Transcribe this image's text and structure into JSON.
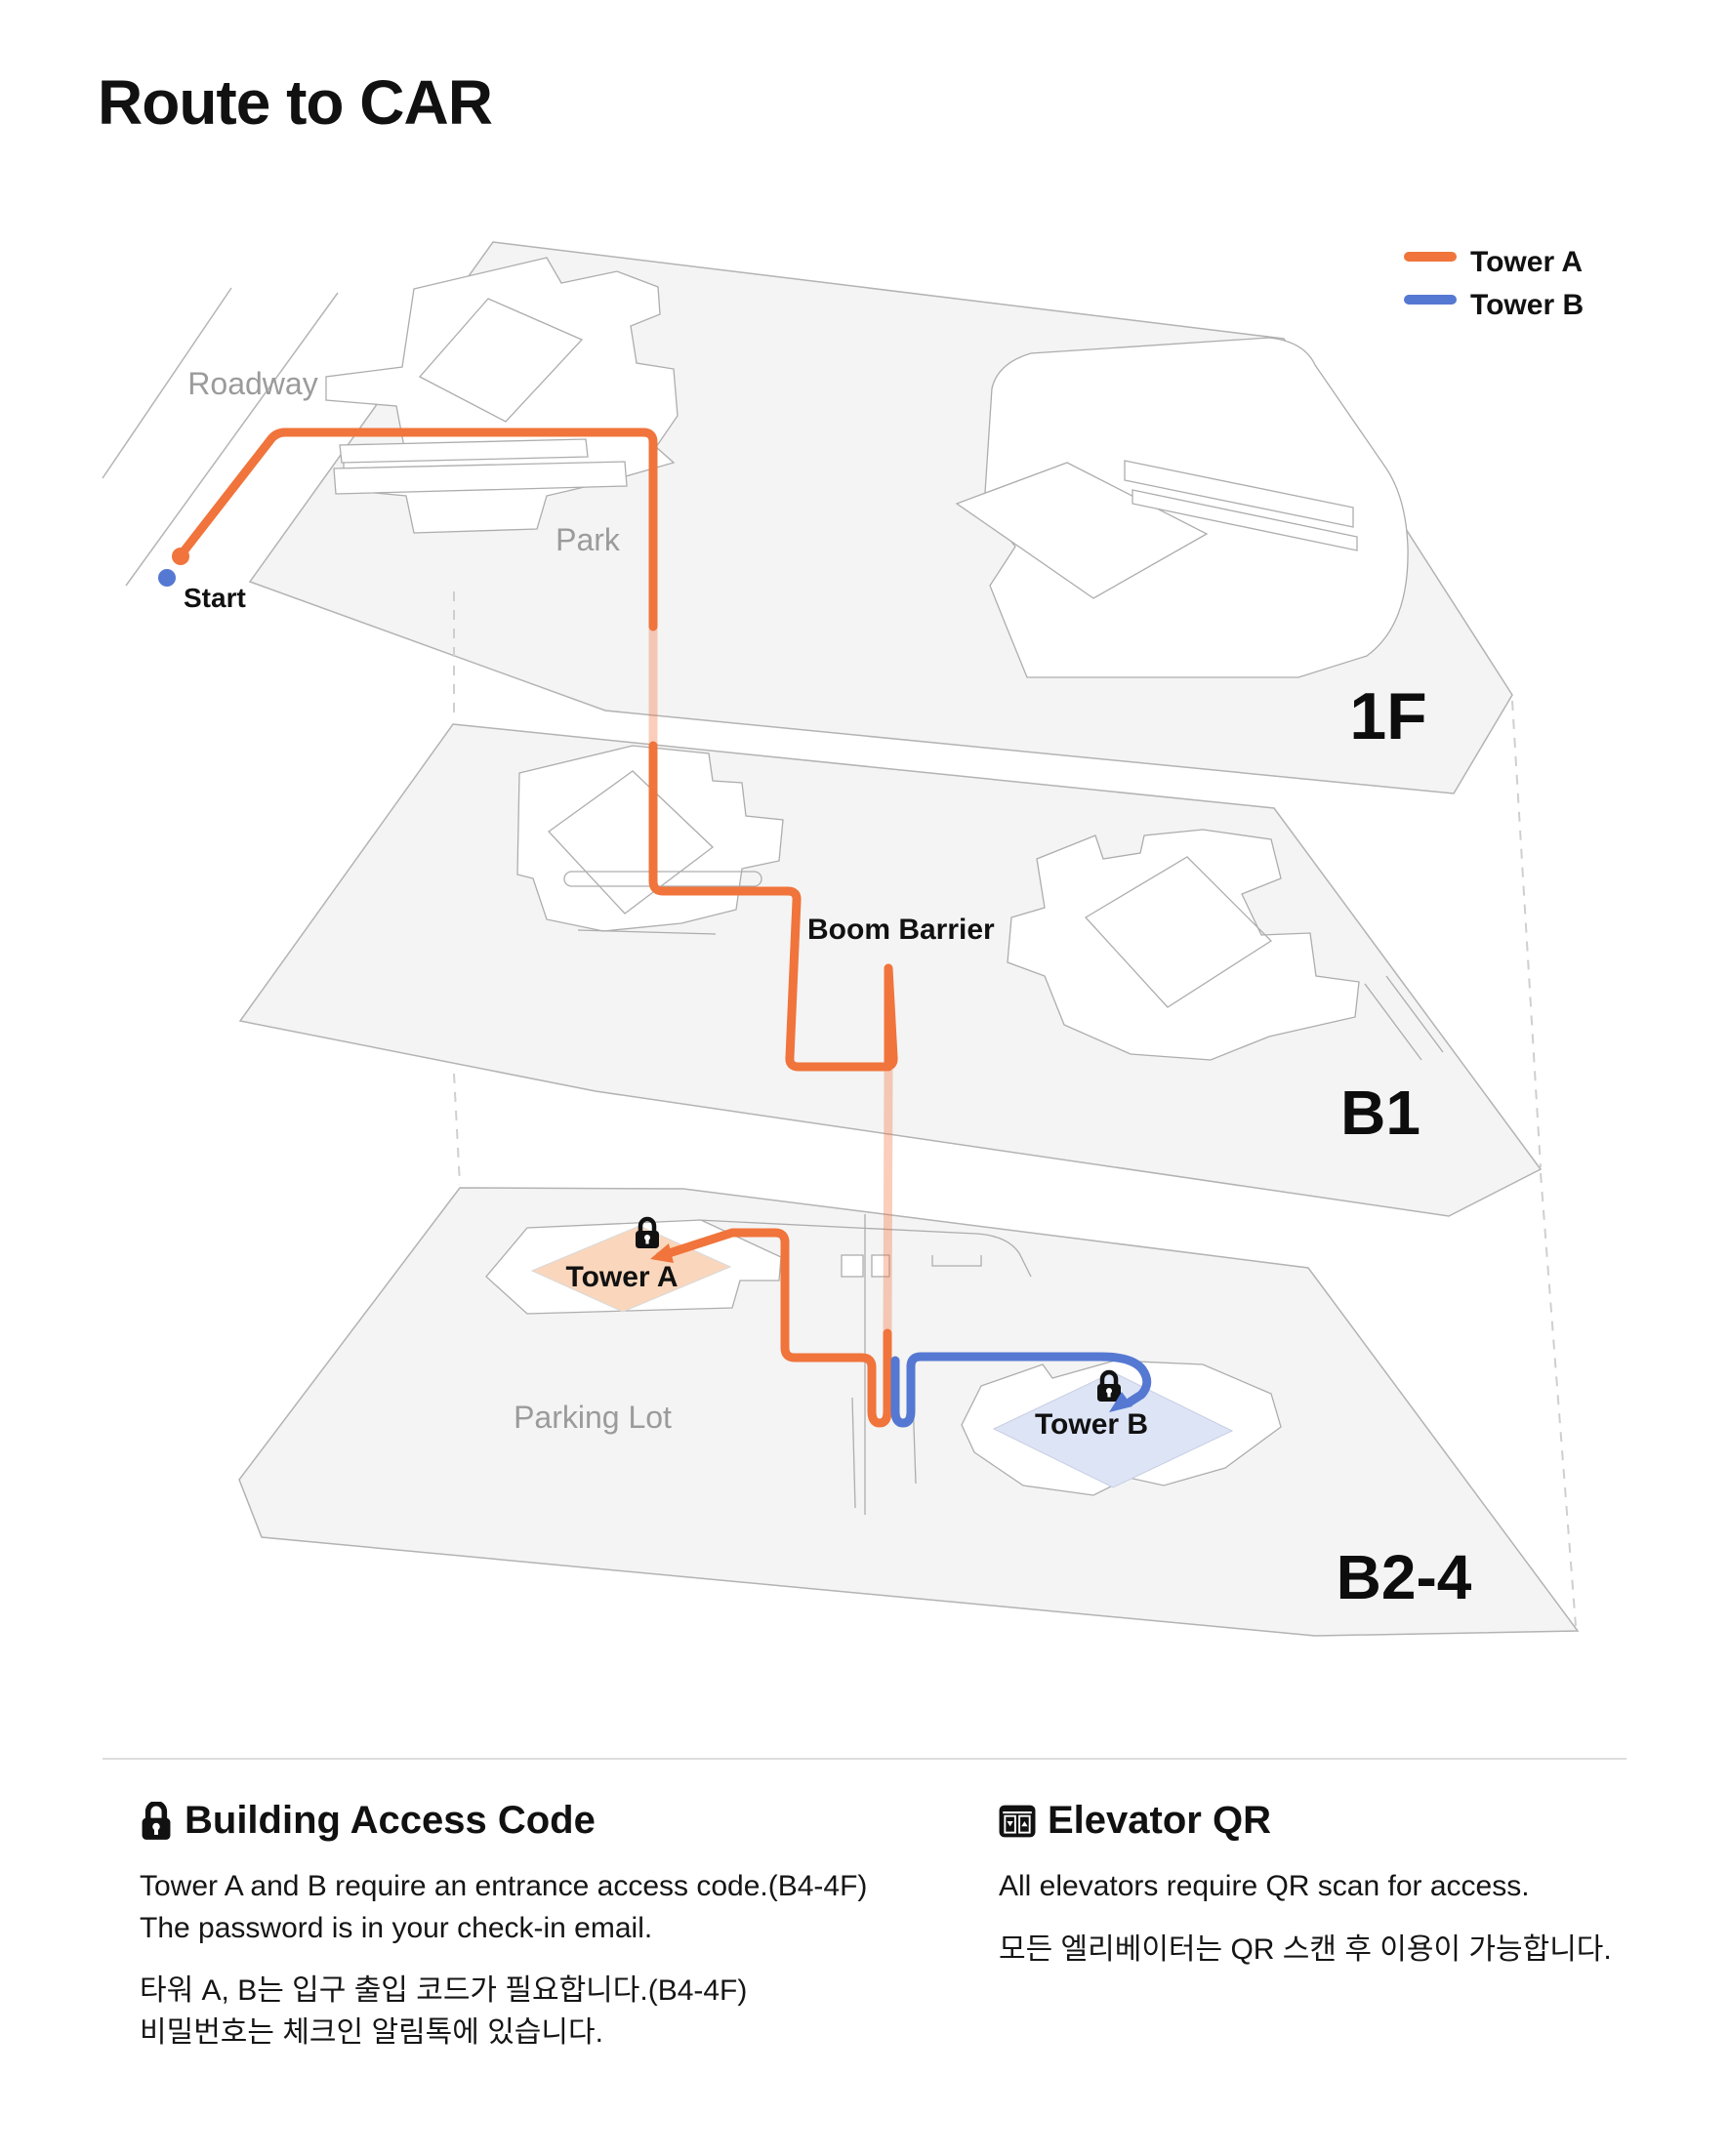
{
  "header": {
    "title": "Route to CAR"
  },
  "legend": {
    "items": [
      {
        "label": "Tower A",
        "color": "#F0743B"
      },
      {
        "label": "Tower B",
        "color": "#5578D2"
      }
    ]
  },
  "map": {
    "floor_labels": {
      "f1": "1F",
      "b1": "B1",
      "b24": "B2-4"
    },
    "area_labels": {
      "roadway": "Roadway",
      "park": "Park",
      "parking_lot": "Parking Lot"
    },
    "route_labels": {
      "start": "Start",
      "boom_barrier": "Boom Barrier",
      "tower_a": "Tower A",
      "tower_b": "Tower B"
    },
    "colors": {
      "tower_a_route": "#F0743B",
      "tower_b_route": "#5578D2",
      "tower_a_fill": "#FAD7BC",
      "tower_b_fill": "#DDE4F6",
      "floor_fill": "#F4F4F4",
      "floor_outline": "#B3B3B3",
      "label_gray": "#9B9B9B"
    }
  },
  "footer": {
    "access": {
      "title": "Building Access Code",
      "line_en_1": "Tower A and B require an entrance access code.(B4-4F)",
      "line_en_2": "The password is in your check-in email.",
      "line_ko_1": "타워 A, B는 입구 출입 코드가 필요합니다.(B4-4F)",
      "line_ko_2": "비밀번호는 체크인 알림톡에 있습니다."
    },
    "elevator": {
      "title": "Elevator QR",
      "line_en": "All elevators require QR scan for access.",
      "line_ko": "모든 엘리베이터는 QR 스캔 후 이용이 가능합니다."
    }
  }
}
